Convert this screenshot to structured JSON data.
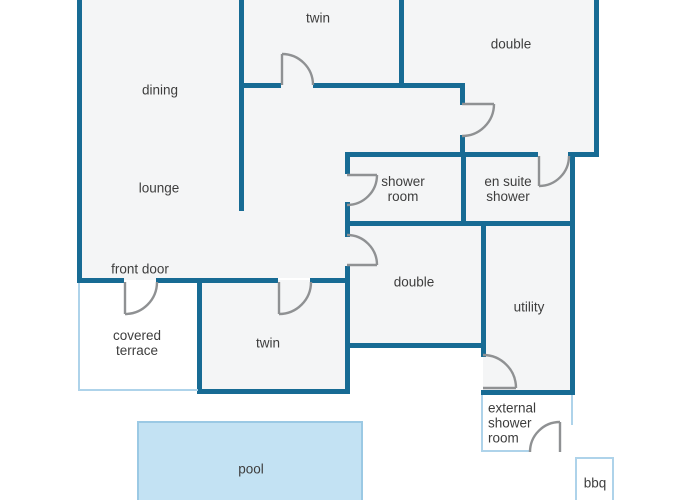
{
  "diagram_type": "floor-plan",
  "labels": {
    "twin_top": "twin",
    "double_top": "double",
    "dining": "dining",
    "lounge": "lounge",
    "shower_room": "shower room",
    "en_suite_shower": "en suite shower",
    "double_bottom": "double",
    "utility": "utility",
    "front_door": "front door",
    "covered_terrace": "covered terrace",
    "twin_bottom": "twin",
    "external_shower_room": "external shower room",
    "pool": "pool",
    "bbq": "bbq"
  },
  "colors": {
    "wall": "#176b94",
    "outdoor_wall": "#aed3ea",
    "room_fill": "#f4f5f6",
    "pool_fill": "#c3e2f3",
    "pool_border": "#9bc9e4",
    "door": "#8f9193",
    "text": "#3d3d3d",
    "background": "#ffffff"
  }
}
